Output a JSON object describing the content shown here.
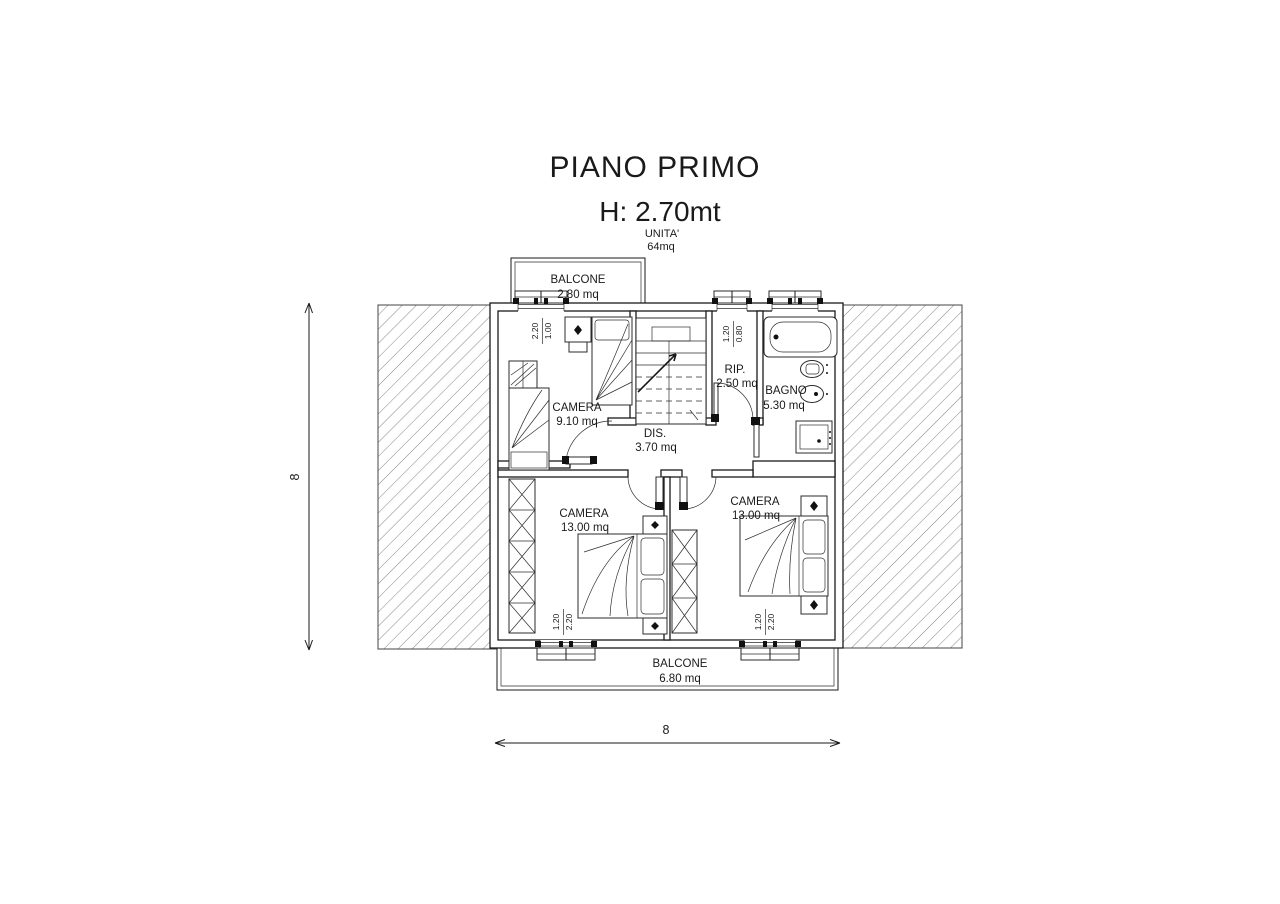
{
  "page": {
    "background": "#ffffff",
    "line_color": "#1a1a1a",
    "hatch_color": "#666666"
  },
  "header": {
    "title": "PIANO PRIMO",
    "height_label": "H: 2.70mt",
    "unit_label": "UNITA'",
    "unit_area": "64mq"
  },
  "rooms": {
    "balcone_top": {
      "name": "BALCONE",
      "area": "2.80 mq"
    },
    "camera_nord": {
      "name": "CAMERA",
      "area": "9.10 mq"
    },
    "rip": {
      "name": "RIP.",
      "area": "2.50 mq"
    },
    "bagno": {
      "name": "BAGNO",
      "area": "5.30 mq"
    },
    "dis": {
      "name": "DIS.",
      "area": "3.70 mq"
    },
    "camera_sud_ovest": {
      "name": "CAMERA",
      "area": "13.00 mq"
    },
    "camera_sud_est": {
      "name": "CAMERA",
      "area": "13.00 mq"
    },
    "balcone_bottom": {
      "name": "BALCONE",
      "area": "6.80 mq"
    }
  },
  "dimensions": {
    "left": "8",
    "bottom": "8"
  },
  "openings": {
    "win_camera_nord": {
      "w": "1.00",
      "h": "2.20"
    },
    "win_rip": {
      "w": "0.80",
      "h": "1.20"
    },
    "win_bagno": {
      "w": "1.00",
      "h": "2.20"
    },
    "win_camera_sud_ovest": {
      "w": "1.20",
      "h": "2.20"
    },
    "win_camera_sud_est": {
      "w": "1.20",
      "h": "2.20"
    }
  }
}
